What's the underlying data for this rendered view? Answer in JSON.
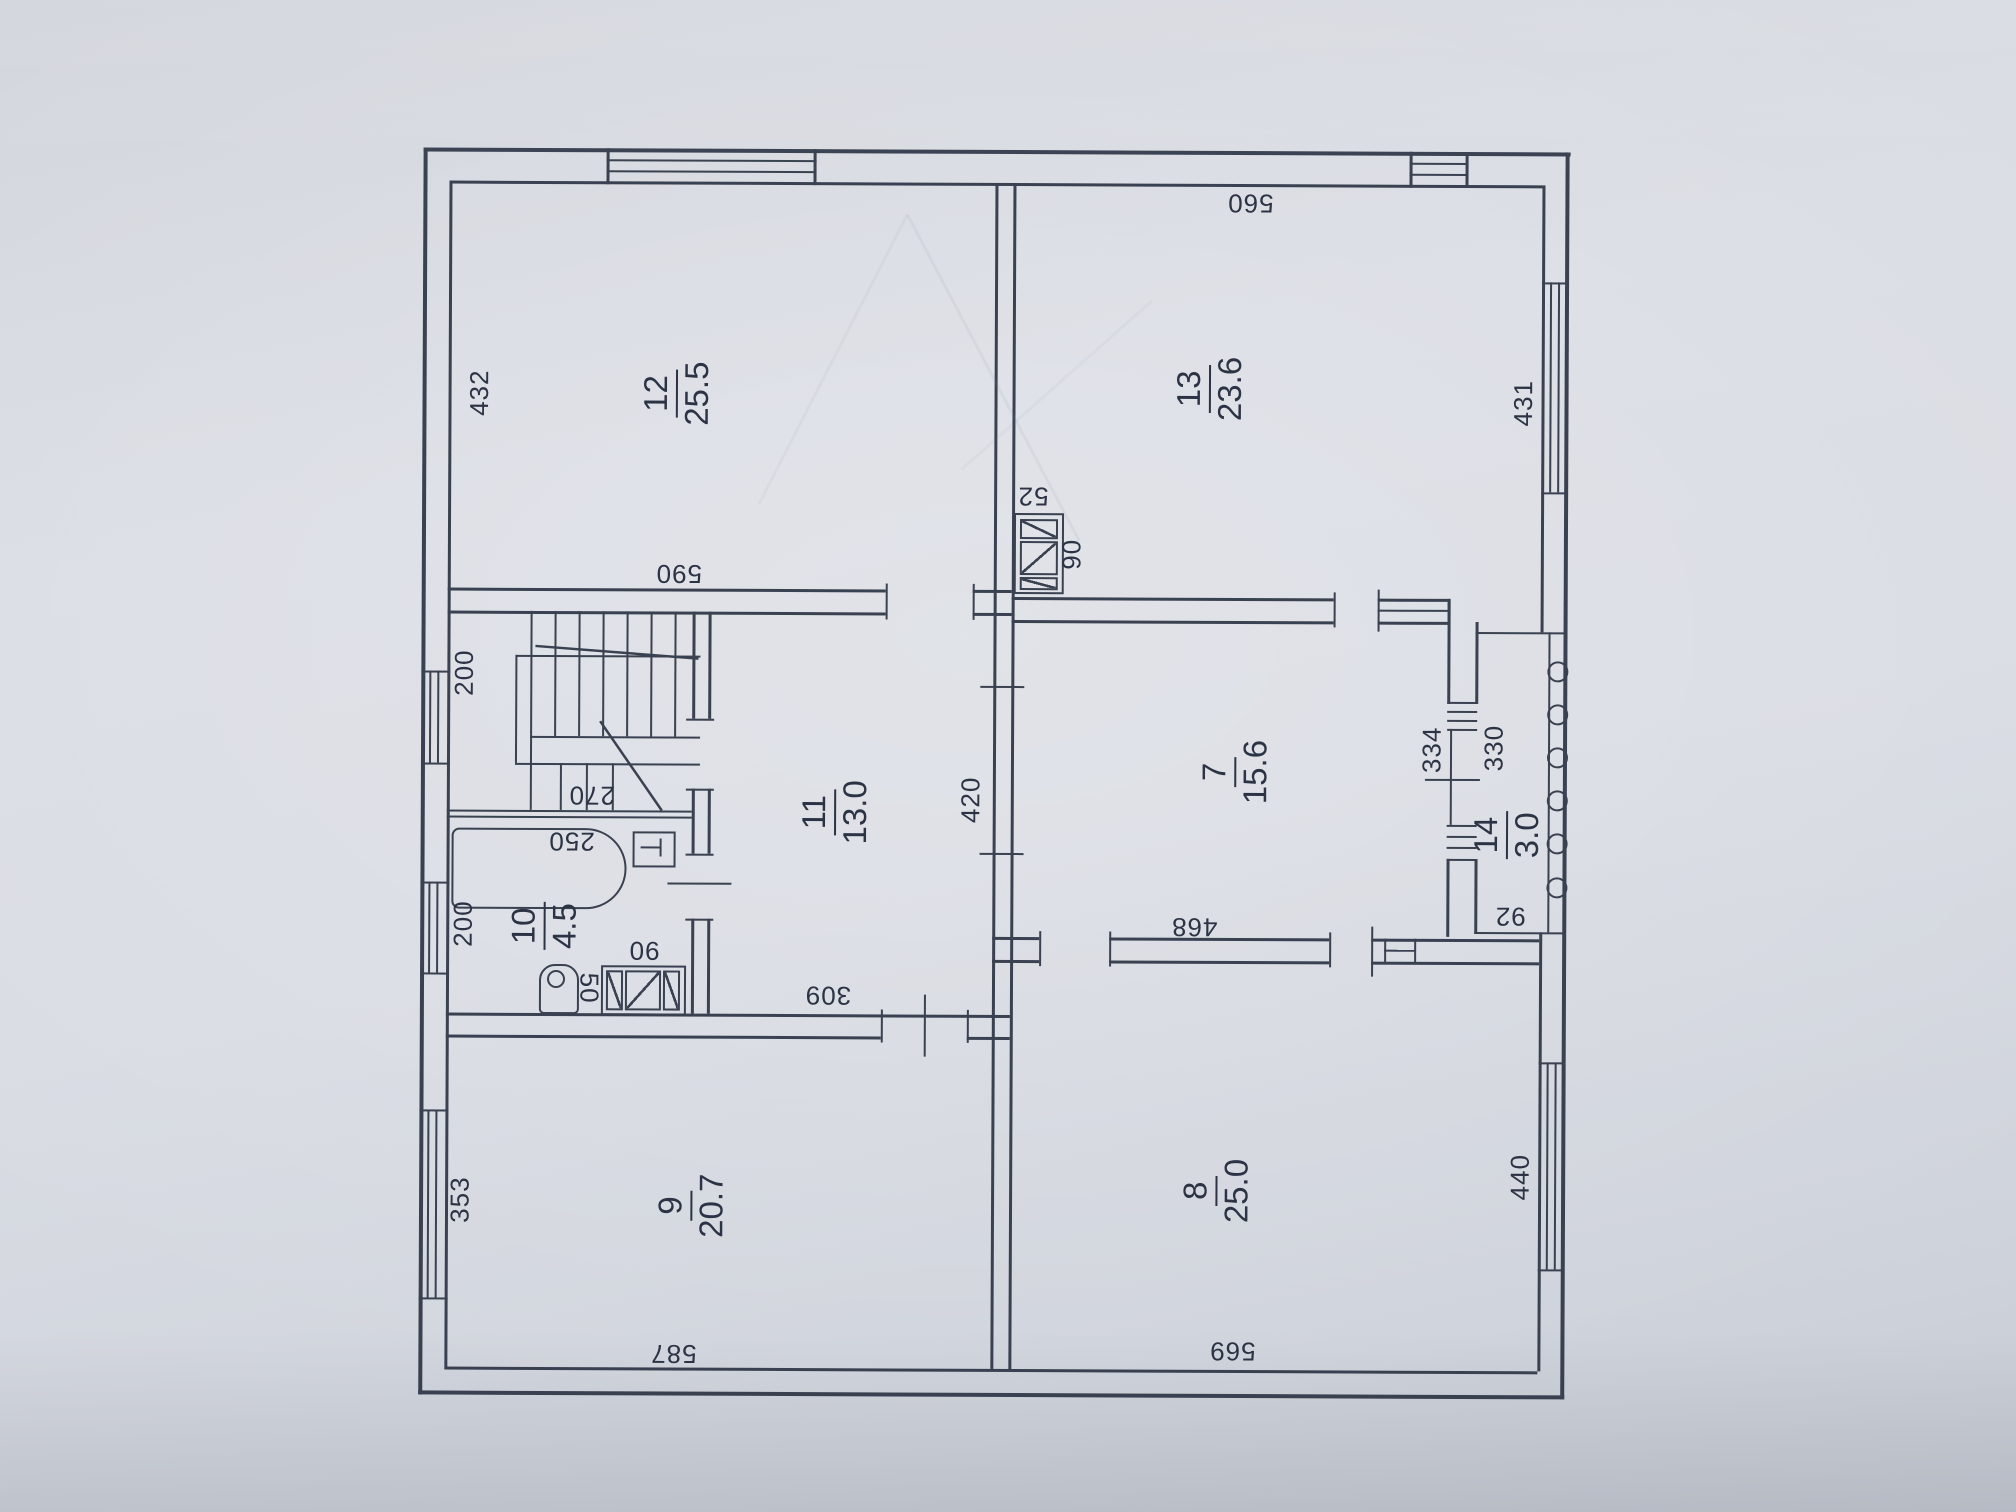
{
  "document": {
    "kind": "floor-plan-photo",
    "ink_color": "#3a4150",
    "paper_color": "#d9dce3"
  },
  "rooms": [
    {
      "number": "12",
      "area": "25.5"
    },
    {
      "number": "13",
      "area": "23.6"
    },
    {
      "number": "11",
      "area": "13.0"
    },
    {
      "number": "7",
      "area": "15.6"
    },
    {
      "number": "14",
      "area": "3.0"
    },
    {
      "number": "10",
      "area": "4.5"
    },
    {
      "number": "9",
      "area": "20.7"
    },
    {
      "number": "8",
      "area": "25.0"
    }
  ],
  "dims": {
    "room12_side": "432",
    "room12_bottom": "590",
    "room13_top": "560",
    "room13_side": "431",
    "vent_main_w": "52",
    "vent_main_h": "90",
    "stair_hall": "200",
    "stair_flight": "270",
    "bath_wall": "200",
    "bathtub": "250",
    "bath_vent_w": "90",
    "bath_vent_h": "50",
    "hall_opening": "309",
    "room11_side": "420",
    "room7_bottom": "468",
    "room7_side": "334",
    "balcony_side": "330",
    "balcony_width": "92",
    "room9_side": "353",
    "room9_bottom": "587",
    "room8_bottom": "569",
    "room8_side": "440"
  }
}
